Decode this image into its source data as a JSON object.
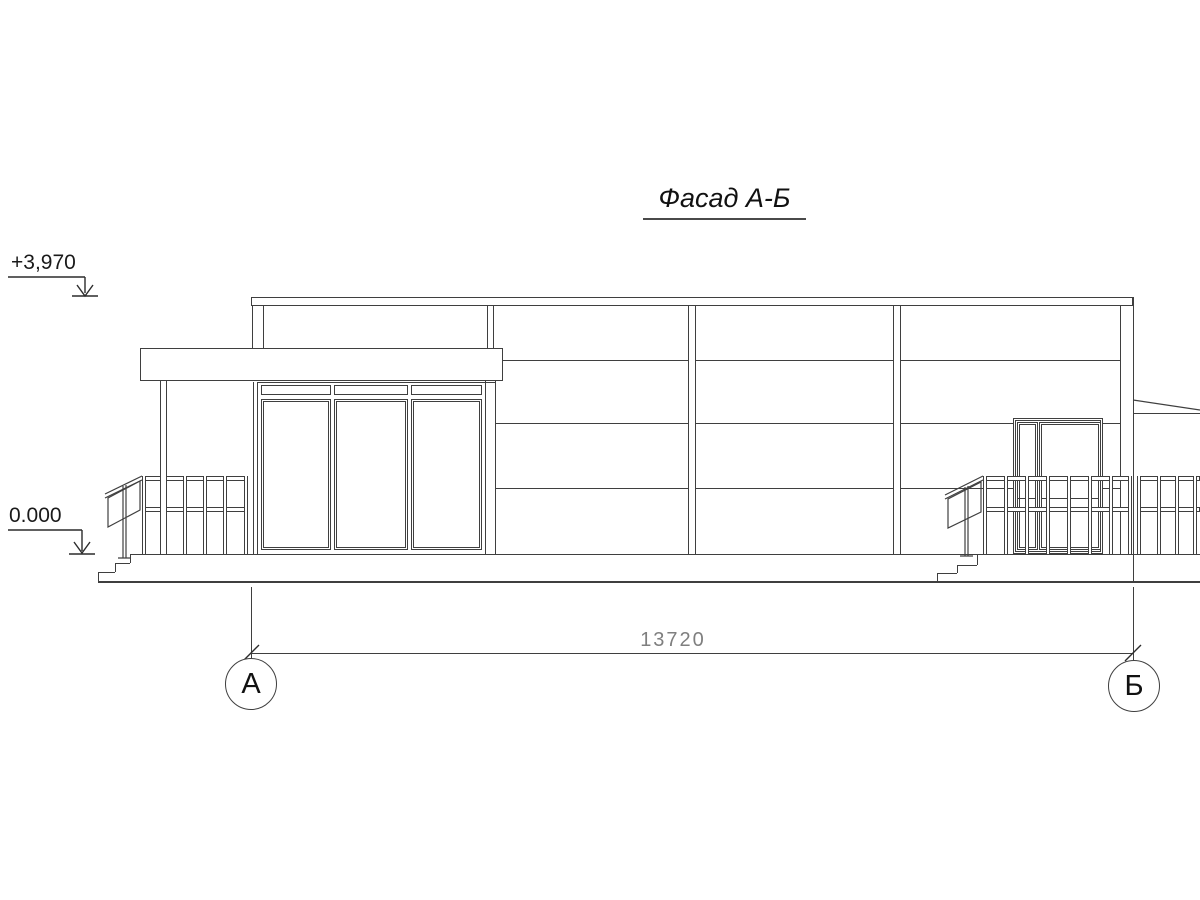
{
  "drawing": {
    "title": "Фасад А-Б",
    "elevation_markers": [
      {
        "label": "+3,970"
      },
      {
        "label": "0.000"
      }
    ],
    "dimension": {
      "value": "13720"
    },
    "axes": [
      {
        "label": "А"
      },
      {
        "label": "Б"
      }
    ]
  },
  "colors": {
    "ink": "#3f3f3f",
    "dim_text": "#7f7f7f",
    "background": "#ffffff"
  }
}
